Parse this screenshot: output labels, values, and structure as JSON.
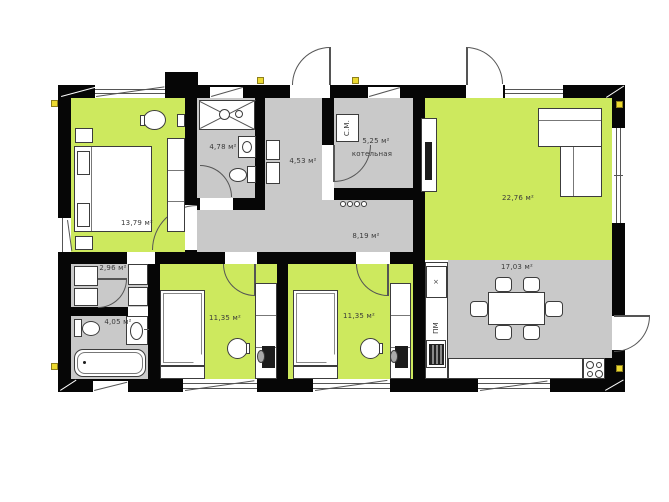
{
  "plan": {
    "title": "single-storey house floor plan",
    "rooms": [
      {
        "id": "bedroom-1",
        "area_label": "13,79 м²"
      },
      {
        "id": "bathroom-1",
        "area_label": "4,78 м²"
      },
      {
        "id": "hallway",
        "area_label": "4,53 м²"
      },
      {
        "id": "boiler-room",
        "area_label": "5,25 м²",
        "name": "котельная"
      },
      {
        "id": "living-room",
        "area_label": "22,76 м²"
      },
      {
        "id": "corridor",
        "area_label": "8,19 м²"
      },
      {
        "id": "closet",
        "area_label": "2,96 м²"
      },
      {
        "id": "bathroom-2",
        "area_label": "4,05 м²"
      },
      {
        "id": "bedroom-2",
        "area_label": "11,35 м²"
      },
      {
        "id": "bedroom-3",
        "area_label": "11,35 м²"
      },
      {
        "id": "kitchen-dining",
        "area_label": "17,03 м²"
      }
    ],
    "appliance_labels": {
      "washing_machine": "С.М.",
      "dishwasher": "ПМ",
      "fridge": "×"
    },
    "colors": {
      "room_green": "#cde95e",
      "room_gray": "#c9c9c9",
      "wall_black": "#060606",
      "marker_yellow": "#ecd92f"
    }
  }
}
